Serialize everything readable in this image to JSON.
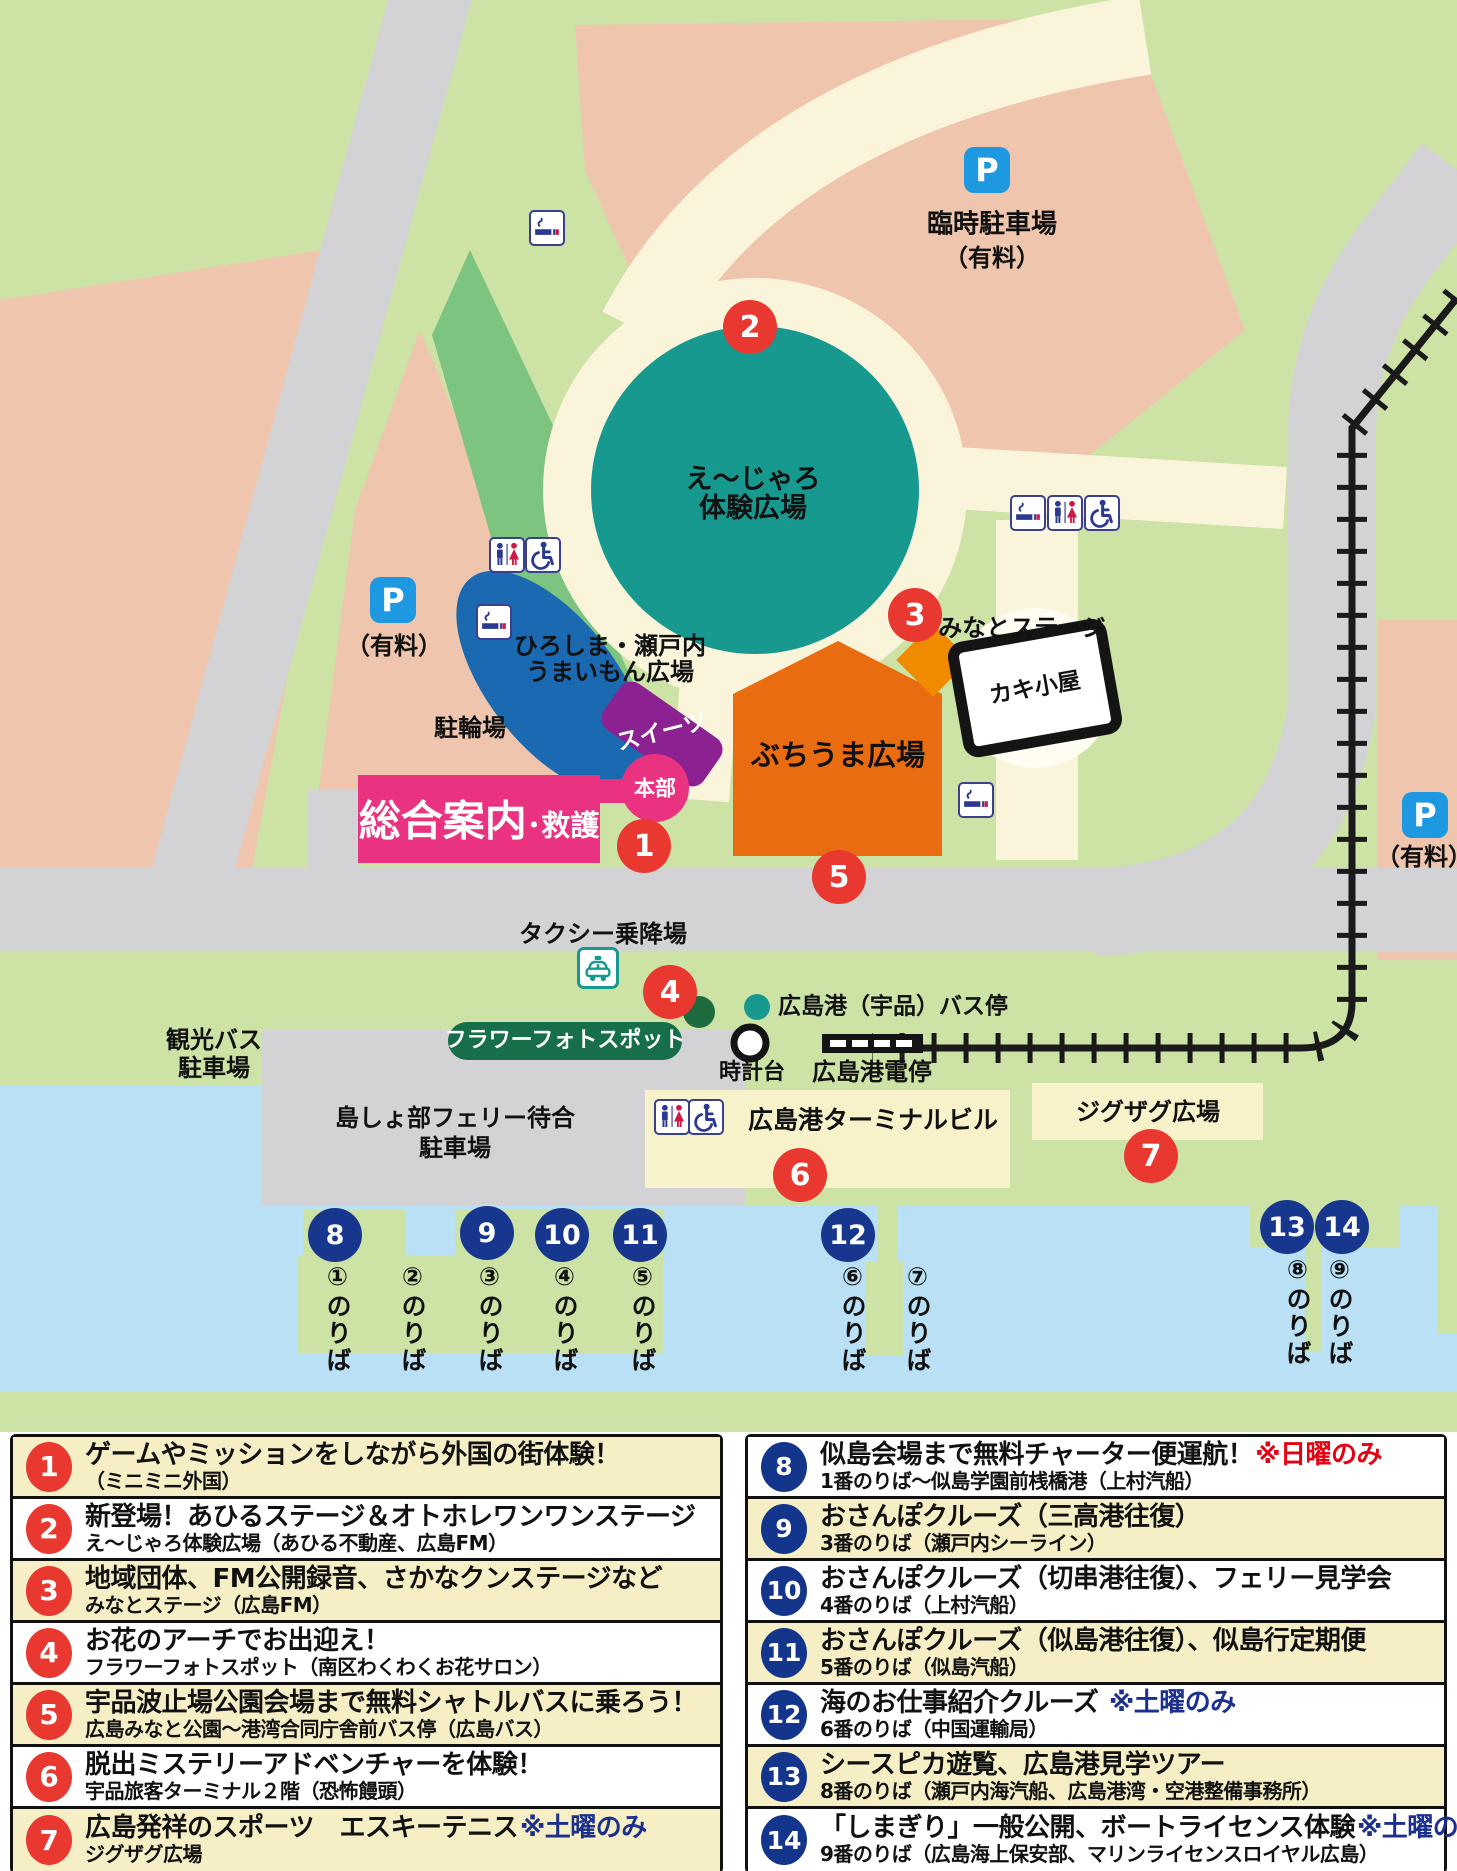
{
  "colors": {
    "park_green": "#cde2a5",
    "path_cream": "#faf4da",
    "parking_pink": "#efc6ad",
    "road_gray": "#d3d3d6",
    "water_blue": "#b9e0f4",
    "venue_teal": "#18998f",
    "venue_blue": "#1b69b1",
    "venue_purple": "#8c2191",
    "venue_magenta": "#ea3380",
    "venue_orange": "#e96d10",
    "stage_orange": "#f08b00",
    "area_yellow": "#f8f2cb",
    "marker_red": "#e8382f",
    "marker_blue": "#17368e",
    "p_icon_blue": "#1e98e0",
    "flower_green": "#166f48"
  },
  "map": {
    "p_label": "P",
    "labels": {
      "temp_parking": "臨時駐車場",
      "paid": "（有料）",
      "ejaro1": "え〜じゃろ",
      "ejaro2": "体験広場",
      "umaimon1": "ひろしま・瀬戸内",
      "umaimon2": "うまいもん広場",
      "sweets": "スイーツ",
      "honbu": "本部",
      "sogo": "総合案内",
      "kyugo": "･救護",
      "churinjo": "駐輪場",
      "buchiuma": "ぶちうま広場",
      "minato_stage": "みなとステージ",
      "kaki_goya": "カキ小屋",
      "taxi": "タクシー乗降場",
      "flower": "フラワーフォトスポット",
      "bus_stop": "広島港（宇品）バス停",
      "clock": "時計台",
      "tram_stop": "広島港電停",
      "terminal": "広島港ターミナルビル",
      "zigzag": "ジグザグ広場",
      "ferry1": "島しょ部フェリー待合",
      "ferry2": "駐車場",
      "tourbus1": "観光バス",
      "tourbus2": "駐車場"
    },
    "markers": [
      "1",
      "2",
      "3",
      "4",
      "5",
      "6",
      "7",
      "8",
      "9",
      "10",
      "11",
      "12",
      "13",
      "14"
    ],
    "berths": [
      "①のりば",
      "②のりば",
      "③のりば",
      "④のりば",
      "⑤のりば",
      "⑥のりば",
      "⑦のりば",
      "⑧のりば",
      "⑨のりば"
    ]
  },
  "legend": {
    "left": [
      {
        "num": "1",
        "title": "ゲームやミッションをしながら外国の街体験！",
        "note": "",
        "sub": "（ミニミニ外国）"
      },
      {
        "num": "2",
        "title": "新登場！あひるステージ＆オトホレワンワンステージ",
        "note": "",
        "sub": "え〜じゃろ体験広場（あひる不動産、広島FM）"
      },
      {
        "num": "3",
        "title": "地域団体、FM公開録音、さかなクンステージなど",
        "note": "",
        "sub": "みなとステージ（広島FM）"
      },
      {
        "num": "4",
        "title": "お花のアーチでお出迎え！",
        "note": "",
        "sub": "フラワーフォトスポット（南区わくわくお花サロン）"
      },
      {
        "num": "5",
        "title": "宇品波止場公園会場まで無料シャトルバスに乗ろう！",
        "note": "",
        "sub": "広島みなと公園〜港湾合同庁舎前バス停（広島バス）"
      },
      {
        "num": "6",
        "title": "脱出ミステリーアドベンチャーを体験！",
        "note": "",
        "sub": "宇品旅客ターミナル２階（恐怖饅頭）"
      },
      {
        "num": "7",
        "title": "広島発祥のスポーツ　エスキーテニス",
        "note": "※土曜のみ",
        "sub": "ジグザグ広場"
      }
    ],
    "right": [
      {
        "num": "8",
        "title": "似島会場まで無料チャーター便運航！",
        "note": "※日曜のみ",
        "sub": "1番のりば〜似島学園前桟橋港（上村汽船）"
      },
      {
        "num": "9",
        "title": "おさんぽクルーズ（三高港往復）",
        "note": "",
        "sub": "3番のりば（瀬戸内シーライン）"
      },
      {
        "num": "10",
        "title": "おさんぽクルーズ（切串港往復）、フェリー見学会",
        "note": "",
        "sub": "4番のりば（上村汽船）"
      },
      {
        "num": "11",
        "title": "おさんぽクルーズ（似島港往復）、似島行定期便",
        "note": "",
        "sub": "5番のりば（似島汽船）"
      },
      {
        "num": "12",
        "title": "海のお仕事紹介クルーズ ",
        "note": "※土曜のみ",
        "sub": "6番のりば（中国運輸局）"
      },
      {
        "num": "13",
        "title": "シースピカ遊覧、広島港見学ツアー",
        "note": "",
        "sub": "8番のりば（瀬戸内海汽船、広島港湾・空港整備事務所）"
      },
      {
        "num": "14",
        "title": "「しまぎり」一般公開、ボートライセンス体験",
        "note": "※土曜のみ",
        "sub": "9番のりば（広島海上保安部、マリンライセンスロイヤル広島）"
      }
    ]
  }
}
